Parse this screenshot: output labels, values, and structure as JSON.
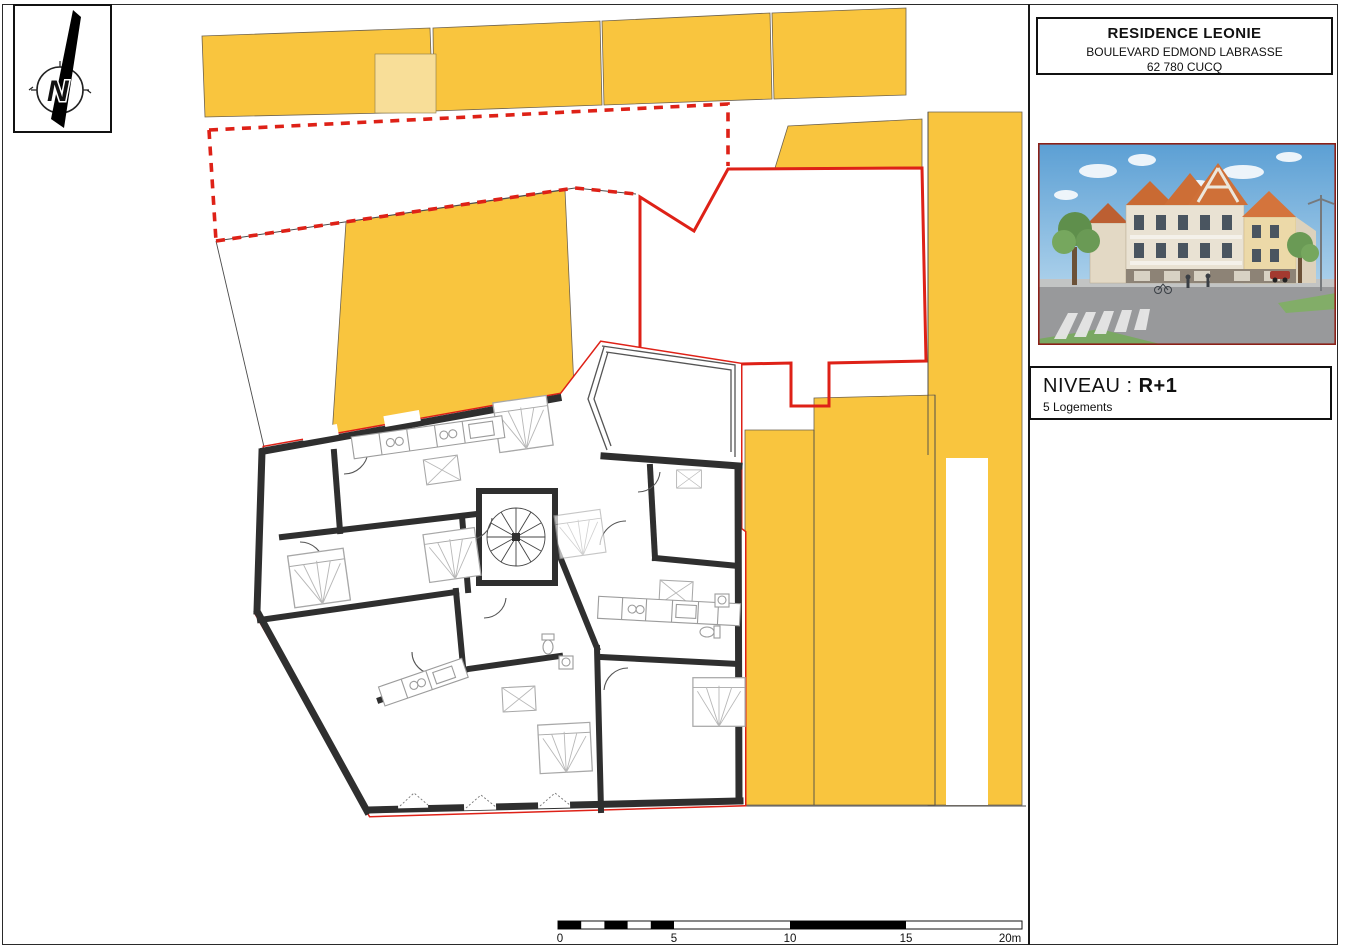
{
  "title_block": {
    "project": "RESIDENCE LEONIE",
    "address": "BOULEVARD EDMOND LABRASSE",
    "city": "62 780 CUCQ"
  },
  "level_panel": {
    "label": "NIVEAU :",
    "value": "R+1",
    "subtitle": "5 Logements"
  },
  "compass": {
    "letter": "N"
  },
  "scale_bar": {
    "labels": [
      "0",
      "5",
      "10",
      "15",
      "20m"
    ]
  },
  "colors": {
    "parcel_yellow": "#F9C53E",
    "parcel_light_yellow": "#F8DE98",
    "boundary_red": "#DE2117",
    "wall_dark": "#2F2F2F"
  }
}
